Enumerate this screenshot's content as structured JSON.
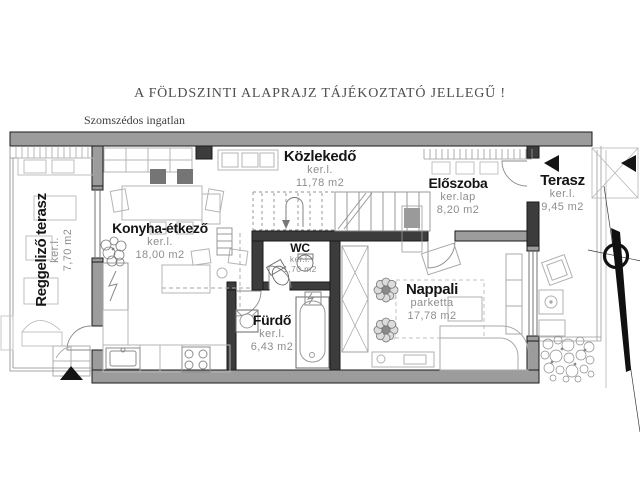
{
  "title": "A FÖLDSZINTI ALAPRAJZ TÁJÉKOZTATÓ JELLEGŰ !",
  "neighbor_label": "Szomszédos ingatlan",
  "rooms": {
    "reggelizo_terasz": {
      "name": "Reggeliző terasz",
      "finish": "ker.l.",
      "area": "7,70 m2"
    },
    "konyha_etkezo": {
      "name": "Konyha-étkező",
      "finish": "ker.l.",
      "area": "18,00 m2"
    },
    "kozlekedo": {
      "name": "Közlekedő",
      "finish": "ker.l.",
      "area": "11,78 m2"
    },
    "eloszoba": {
      "name": "Előszoba",
      "finish": "ker.lap",
      "area": "8,20 m2"
    },
    "terasz": {
      "name": "Terasz",
      "finish": "ker.l.",
      "area": "9,45 m2"
    },
    "wc": {
      "name": "WC",
      "finish": "ker.l.",
      "area": "1,70 m2"
    },
    "furdo": {
      "name": "Fürdő",
      "finish": "ker.l.",
      "area": "6,43 m2"
    },
    "nappali": {
      "name": "Nappali",
      "finish": "parketta",
      "area": "17,78 m2"
    }
  },
  "colors": {
    "wall_gray": "#9c9c9c",
    "wall_dark": "#3c3c3c",
    "outline": "#1a1a1a",
    "furniture": "#b4b4b4",
    "fixture": "#666666",
    "label_text": "#151515",
    "sub_text": "#8e8e8e"
  }
}
